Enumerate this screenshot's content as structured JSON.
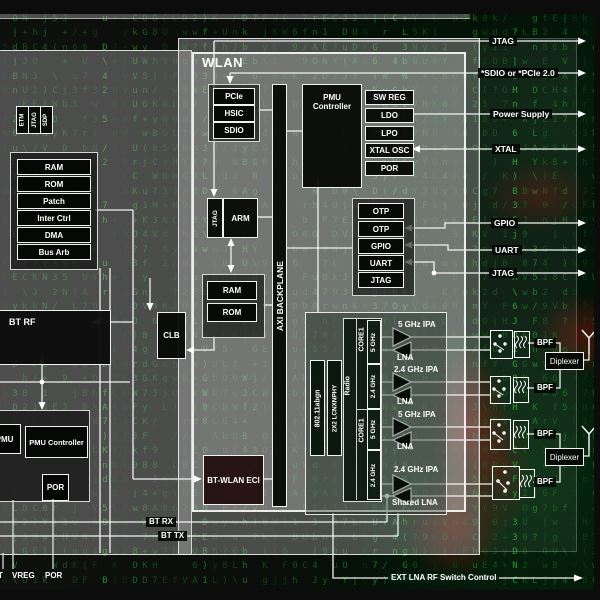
{
  "background": {
    "matrix_alphabet": "ABCDEFGHJKLNUVWYOdhnwyufbgkrj0123456789/\\()+?|"
  },
  "bt": {
    "top_tags": [
      "ETM",
      "JTAG",
      "SDP"
    ],
    "cpu_blocks": [
      "RAM",
      "ROM",
      "Patch",
      "Inter Ctrl",
      "DMA",
      "Bus Arb"
    ],
    "bt_rf_label": "BT RF",
    "pmu_label": "PMU",
    "pmu_controller_label": "PMU Controller",
    "por_label": "POR",
    "clb_label": "CLB",
    "bt_wlan_eci_label": "BT-WLAN ECI",
    "bt_rx_label": "BT RX",
    "bt_tx_label": "BT TX",
    "bottom_labels": [
      "T",
      "VREG",
      "POR"
    ]
  },
  "wlan": {
    "title": "WLAN",
    "host_interfaces": [
      "PCIe",
      "HSIC",
      "SDIO"
    ],
    "axi_label": "AXI BACKPLANE",
    "pmu_controller_label": "PMU Controller",
    "power_blocks": [
      "SW REG",
      "LDO",
      "LPO",
      "XTAL OSC",
      "POR"
    ],
    "jtag_label": "JTAG",
    "arm_label": "ARM",
    "ram_label": "RAM",
    "rom_label": "ROM",
    "otp_blocks": [
      "OTP",
      "OTP",
      "GPIO",
      "UART",
      "JTAG"
    ],
    "radio": {
      "mac_label": "802.11abgn",
      "phy_label": "2X2 LCNXNPHY",
      "radio_label": "Radio",
      "cores": [
        {
          "name": "CORE1",
          "bands": [
            "5 GHz",
            "2.4 GHz"
          ]
        },
        {
          "name": "CORE1",
          "bands": [
            "5 GHz",
            "2.4 GHz"
          ]
        }
      ]
    },
    "amps": [
      {
        "ipa": "5 GHz IPA",
        "lna": "LNA"
      },
      {
        "ipa": "2.4 GHz IPA",
        "lna": "LNA"
      },
      {
        "ipa": "5 GHz IPA",
        "lna": "LNA"
      },
      {
        "ipa": "2.4 GHz IPA",
        "lna": "Shared LNA"
      }
    ]
  },
  "rf": {
    "bpf_labels": [
      "BPF",
      "BPF",
      "BPF",
      "BPF"
    ],
    "diplexer_labels": [
      "Diplexer",
      "Diplexer"
    ]
  },
  "external": {
    "right": [
      "JTAG",
      "*SDIO or *PCIe 2.0",
      "Power Supply",
      "XTAL",
      "GPIO",
      "UART",
      "JTAG"
    ],
    "bottom_control": "EXT LNA RF Switch Control"
  },
  "colors": {
    "matrix_green": "#2e8b2e",
    "blob_red": "#8a0f0a",
    "panel_gray": "#c6c8c6"
  }
}
